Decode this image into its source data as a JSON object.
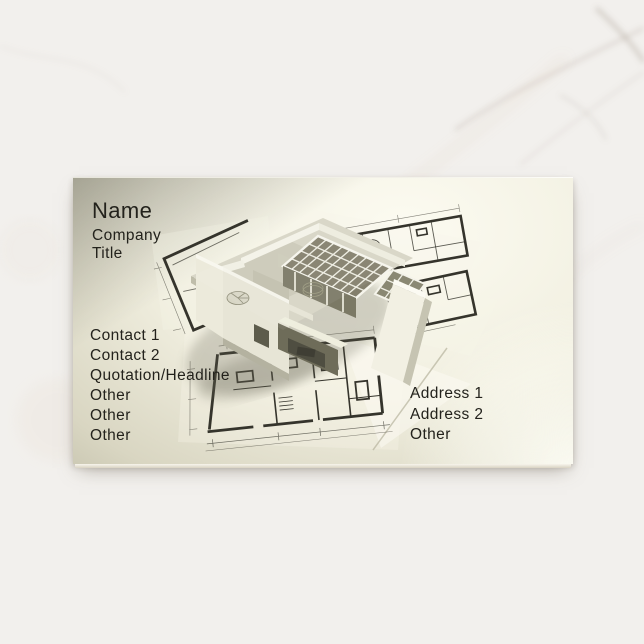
{
  "background": {
    "type": "white-marble-surface"
  },
  "card": {
    "header": {
      "name": "Name",
      "company": "Company",
      "title": "Title"
    },
    "contact_lines": [
      "Contact 1",
      "Contact 2",
      "Quotation/Headline",
      "Other",
      "Other",
      "Other"
    ],
    "address_lines": [
      "Address 1",
      "Address 2",
      "Other"
    ],
    "artwork_alt": "3D architectural model standing on rolled-out blueprints",
    "colors": {
      "text": "#23221c",
      "card_highlight": "#fbfaf1",
      "card_shadow_tone": "#6f6e59",
      "blueprint_ink": "#35342c"
    }
  }
}
